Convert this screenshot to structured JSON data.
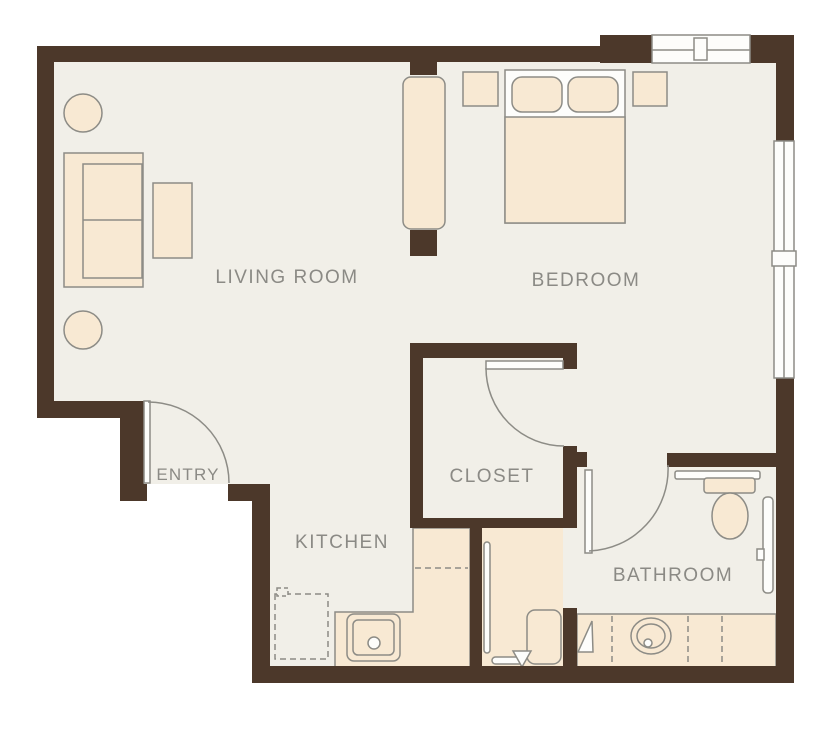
{
  "title": "One-bedroom apartment floor plan",
  "rooms": {
    "living_room": {
      "label": "LIVING ROOM"
    },
    "bedroom": {
      "label": "BEDROOM"
    },
    "entry": {
      "label": "ENTRY"
    },
    "closet": {
      "label": "CLOSET"
    },
    "kitchen": {
      "label": "KITCHEN"
    },
    "bathroom": {
      "label": "BATHROOM"
    }
  },
  "colors": {
    "wall": "#4c382a",
    "floor": "#f1efe8",
    "furniture_fill": "#f8e9d3",
    "shower_floor": "#f8e9d3",
    "outline_gray": "#8d8c86",
    "fixture_white": "#fdfdfb",
    "label_text": "#8b8a85",
    "page_background": "#ffffff"
  },
  "fixtures": {
    "living_room": [
      "side-table-round",
      "sofa",
      "coffee-table",
      "side-table-round",
      "tall-cabinet"
    ],
    "bedroom": [
      "nightstand-left",
      "queen-bed-with-pillows",
      "nightstand-right",
      "window-top",
      "window-right"
    ],
    "kitchen": [
      "refrigerator-dashed",
      "l-shaped-counter",
      "sink",
      "dishwasher-dash-line"
    ],
    "shower": [
      "grab-bar-left",
      "grab-bar-bottom",
      "fold-down-bench",
      "drain-arrow"
    ],
    "bathroom": [
      "toilet",
      "grab-bar-right",
      "vanity-counter",
      "oval-sink",
      "door-swing"
    ]
  },
  "doors": [
    "entry-door",
    "closet-door",
    "bathroom-door"
  ],
  "windows": [
    "bedroom-top-window",
    "bedroom-right-window"
  ]
}
